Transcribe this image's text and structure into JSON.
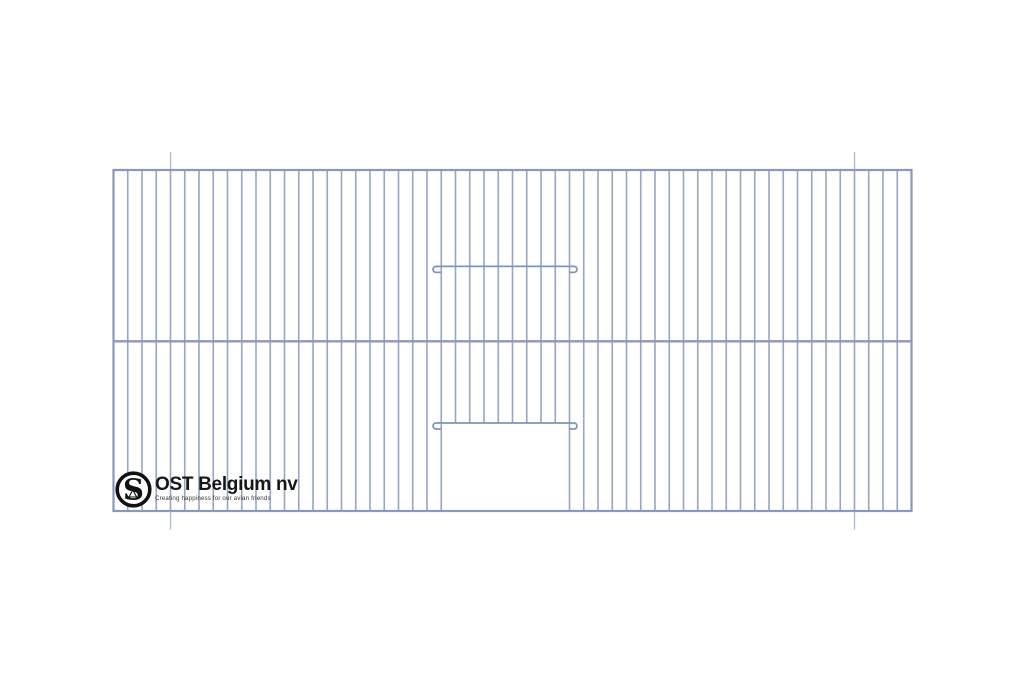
{
  "meta": {
    "canvas_width": 1024,
    "canvas_height": 683,
    "background": "#ffffff",
    "description": "Technical line drawing of a wire bird-cage front panel with bottom-center door opening"
  },
  "logo": {
    "monogram": "S",
    "company_name": "OST Belgium nv",
    "tagline": "Creating happiness for our avian friends",
    "mark_color": "#111111",
    "title_color": "#171717",
    "tagline_color": "#3a3a3a"
  },
  "cage_drawing": {
    "colors": {
      "bar": "#98a6c1",
      "frame": "#8a99b7",
      "mid_rail": "#8c9ab7",
      "hook_wire": "#7f96bb",
      "registration_mark": "#a9b7cf"
    },
    "stroke_widths": {
      "bar": 1.6,
      "frame": 2.2,
      "mid_rail": 2.4,
      "hook_wire": 1.7,
      "registration_mark": 1.3
    },
    "frame": {
      "left": 113.5,
      "top": 170,
      "right": 911.5,
      "bottom": 511
    },
    "grid": {
      "gaps": 56,
      "door_left_bar_index": 23,
      "door_right_bar_index": 32
    },
    "mid_rail_y": 341.3,
    "door_opening_top_y": 423,
    "hook_wires": [
      {
        "y": 266.4
      },
      {
        "y": 423
      }
    ],
    "hook_geometry": {
      "straight_left_x": 436,
      "straight_right_x": 574,
      "tip_left_x": 440.8,
      "tip_right_x": 569.2,
      "curl_radius": 3,
      "curl_drop": 6
    },
    "registration_marks": {
      "bar_indices": [
        4,
        52
      ],
      "above_y": [
        152,
        170
      ],
      "below_y": [
        511,
        529.5
      ]
    }
  }
}
